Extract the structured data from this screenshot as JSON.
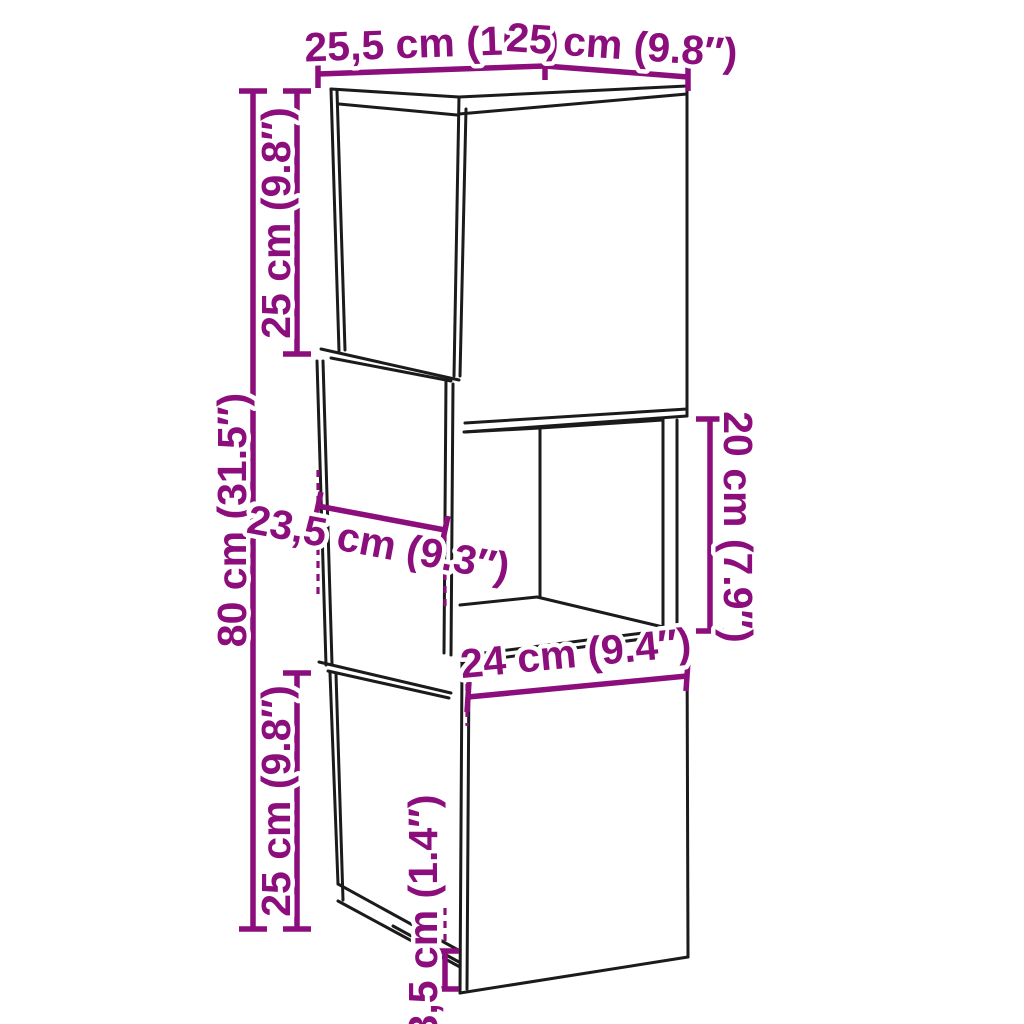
{
  "colors": {
    "accent": "#8B0E7C",
    "ink": "#1b1b1b",
    "bg": "#ffffff"
  },
  "diagram": {
    "labels": {
      "top_width_left": "25,5 cm (10″)",
      "top_width_right": "25 cm (9.8″)",
      "upper_section_height": "25 cm (9.8″)",
      "total_height": "80 cm (31.5″)",
      "middle_depth": "23,5 cm (9.3″)",
      "middle_opening_height": "20 cm (7.9″)",
      "bottom_door_width": "24 cm (9.4″)",
      "lower_section_height": "25 cm (9.8″)",
      "base_gap_height": "3,5 cm (1.4″)"
    }
  }
}
